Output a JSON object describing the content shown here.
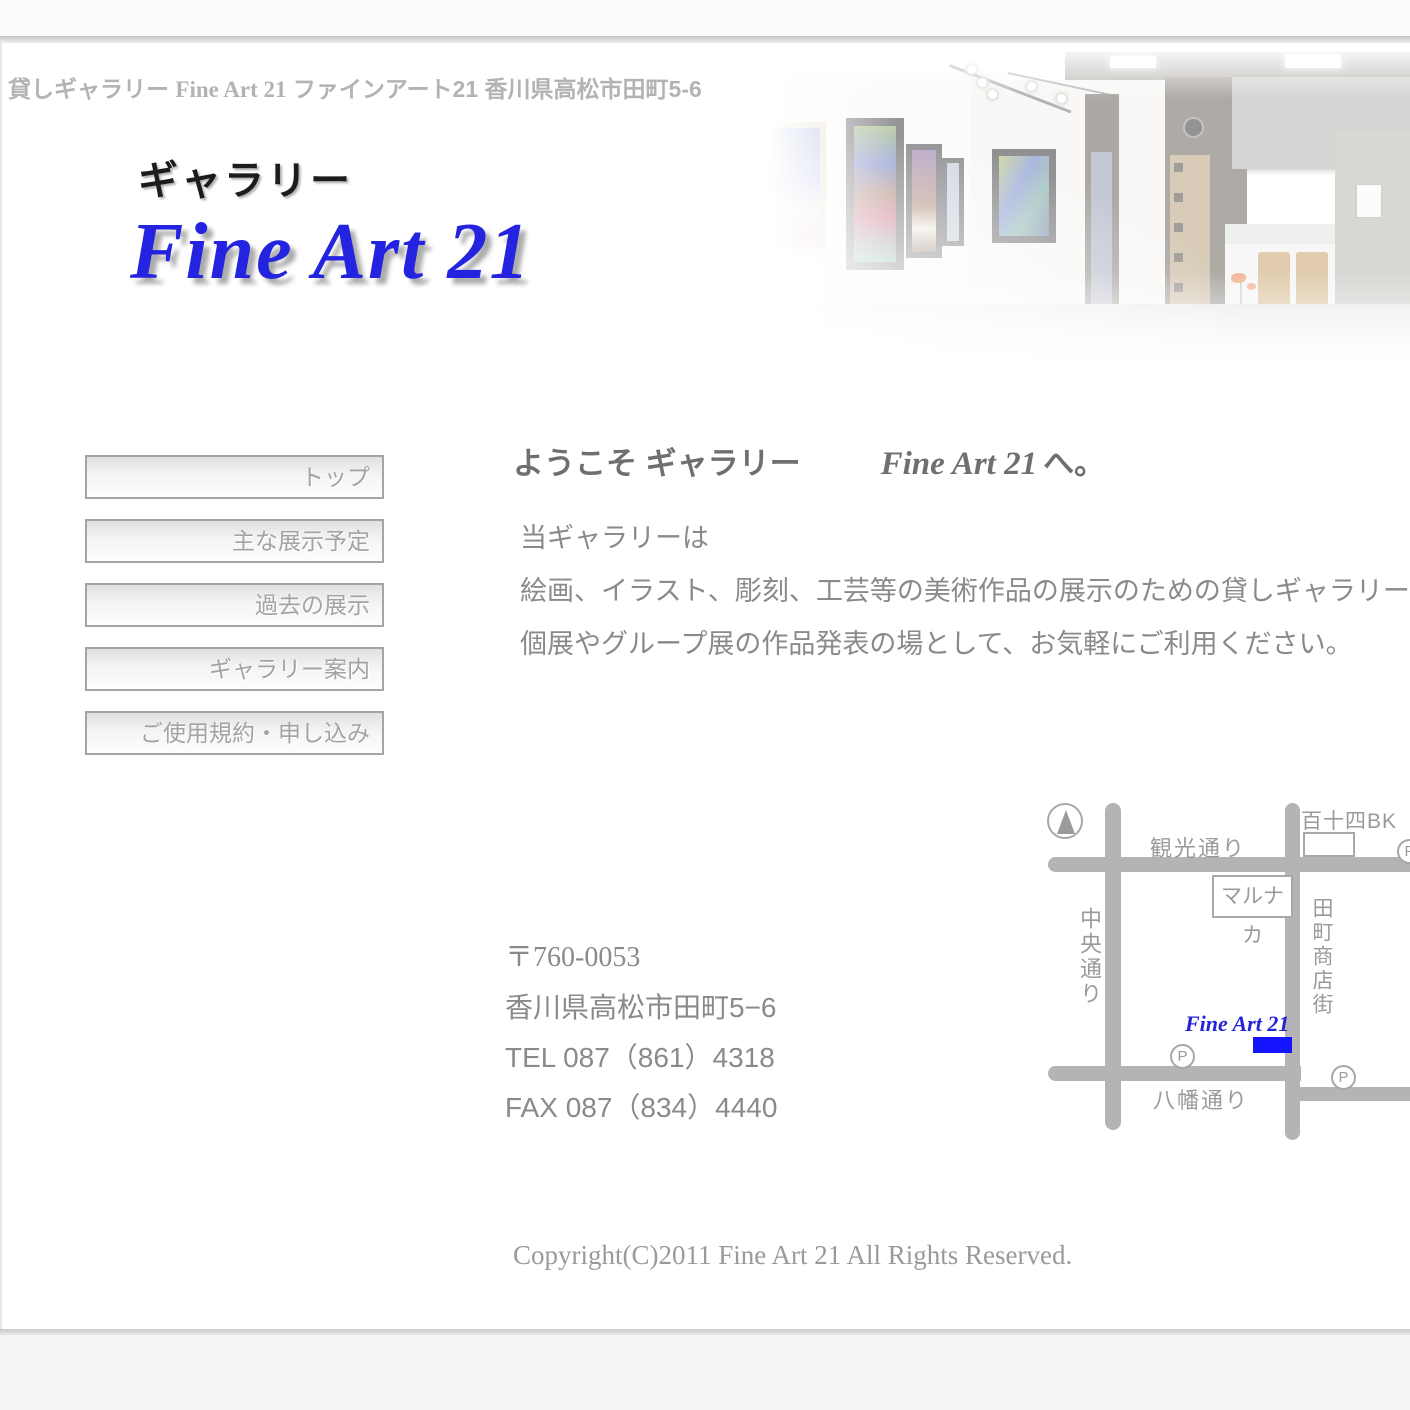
{
  "header": {
    "tagline_prefix": "貸しギャラリー ",
    "tagline_en": "Fine Art 21",
    "tagline_suffix": " ファインアート21 香川県高松市田町5-6",
    "logo_jp": "ギャラリー",
    "logo_en": "Fine Art 21"
  },
  "sidebar": {
    "items": [
      {
        "label": "トップ"
      },
      {
        "label": "主な展示予定"
      },
      {
        "label": "過去の展示"
      },
      {
        "label": "ギャラリー案内"
      },
      {
        "label": "ご使用規約・申し込み"
      }
    ]
  },
  "main": {
    "welcome_jp": "ようこそ ギャラリー",
    "welcome_en": "Fine Art 21",
    "welcome_suffix": "へ。",
    "intro_lines": [
      "当ギャラリーは",
      "絵画、イラスト、彫刻、工芸等の美術作品の展示のための貸しギャラリーです",
      "個展やグループ展の作品発表の場として、お気軽にご利用ください。"
    ],
    "address": {
      "postal": "〒760-0053",
      "street": "香川県高松市田町5−6",
      "tel": "TEL 087（861）4318",
      "fax": "FAX 087（834）4440"
    }
  },
  "map": {
    "roads": {
      "kanko": "観光通り",
      "chuo": "中央通り",
      "tamachi": "田町商店街",
      "yahata": "八幡通り"
    },
    "landmarks": {
      "marunaka": "マルナカ",
      "bank": "百十四BK",
      "gallery_label": "Fine Art 21",
      "parking": "P"
    },
    "colors": {
      "road": "#b4b4b4",
      "gallery_marker": "#1414ff"
    }
  },
  "footer": {
    "copyright": "Copyright(C)2011 Fine Art 21 All Rights Reserved."
  },
  "colors": {
    "logo_blue": "#2424e0",
    "text_gray": "#8a8a8a",
    "muted_gray": "#b3b3b3"
  }
}
